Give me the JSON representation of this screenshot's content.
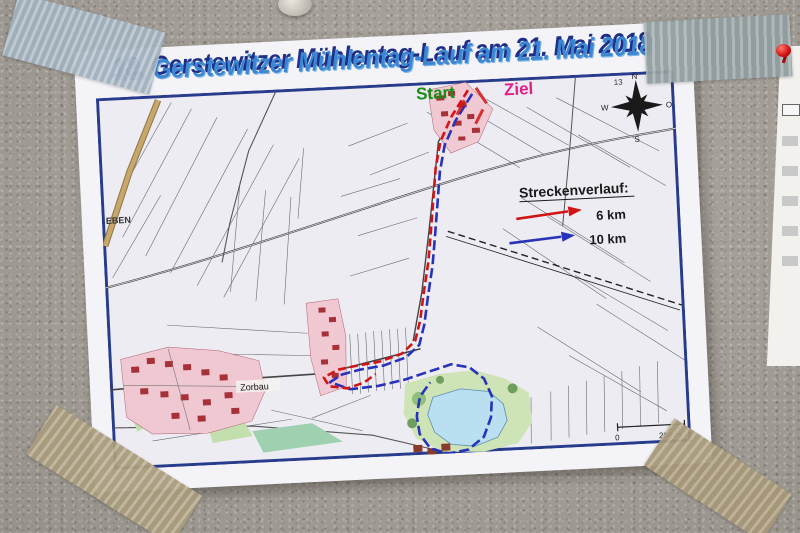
{
  "scene": {
    "wall_color": "#a8a39b",
    "paper_color": "#f4f3f7"
  },
  "poster": {
    "title": "18. Gerstewitzer Mühlentag-Lauf am 21. Mai 2018",
    "title_color": "#3c86d2",
    "title_shadow_color": "#1f2e86"
  },
  "map": {
    "start_label": "Start",
    "start_color": "#169016",
    "ziel_label": "Ziel",
    "ziel_color": "#e41f8a",
    "legend": {
      "title": "Streckenverlauf:",
      "routes": [
        {
          "label": "6 km",
          "color": "#d31414"
        },
        {
          "label": "10 km",
          "color": "#2733b8"
        }
      ]
    },
    "towns": {
      "west": "EBEN",
      "southwest": "Zorbau"
    },
    "compass": {
      "n": "N",
      "e": "O",
      "s": "S",
      "w": "W"
    },
    "scale": {
      "start": "0",
      "end": "264 m"
    },
    "grid_number": "13"
  }
}
